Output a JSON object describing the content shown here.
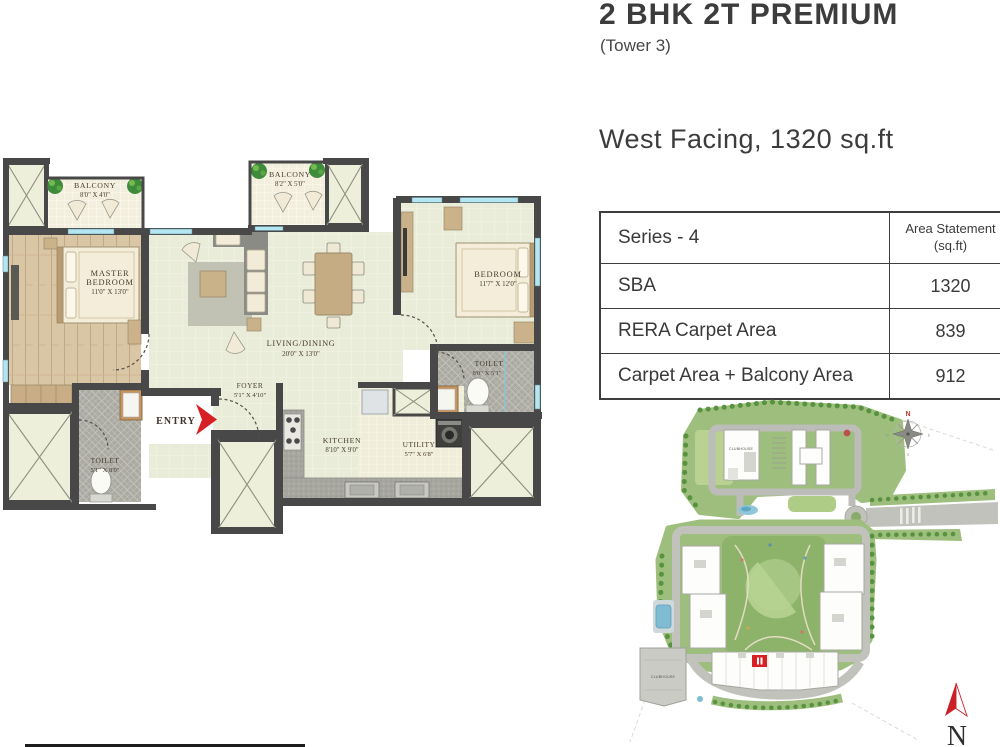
{
  "header": {
    "title": "2 BHK 2T PREMIUM",
    "tower": "(Tower 3)",
    "facing": "West Facing, 1320 sq.ft"
  },
  "area_table": {
    "series_label": "Series - 4",
    "area_header_line1": "Area Statement",
    "area_header_line2": "(sq.ft)",
    "rows": [
      {
        "label": "SBA",
        "value": "1320"
      },
      {
        "label": "RERA Carpet Area",
        "value": "839"
      },
      {
        "label": "Carpet Area + Balcony Area",
        "value": "912"
      }
    ]
  },
  "floorplan": {
    "entry_label": "ENTRY",
    "rooms": {
      "balcony1": {
        "name": "BALCONY",
        "dims": "8'0\" X 4'0\""
      },
      "balcony2": {
        "name": "BALCONY",
        "dims": "8'2\" X 5'0\""
      },
      "master_bedroom": {
        "line1": "MASTER",
        "line2": "BEDROOM",
        "dims": "11'0\" X 13'0\""
      },
      "living_dining": {
        "name": "LIVING/DINING",
        "dims": "20'0\" X 13'0\""
      },
      "bedroom": {
        "name": "BEDROOM",
        "dims": "11'7\" X 12'0\""
      },
      "toilet_right": {
        "name": "TOILET",
        "dims": "8'0\" X 5'1\""
      },
      "toilet_left": {
        "name": "TOILET",
        "dims": "5'1\" X 8'0\""
      },
      "foyer": {
        "name": "FOYER",
        "dims": "5'1\" X 4'10\""
      },
      "kitchen": {
        "name": "KITCHEN",
        "dims": "8'10\" X 9'0\""
      },
      "utility": {
        "name": "UTILITY",
        "dims": "5'7\" X 6'8\""
      }
    }
  },
  "sitemap": {
    "clubhouse_top": "CLUBHOUSE",
    "clubhouse_bottom": "CLUBHOUSE",
    "compass": {
      "n": "N",
      "e": "E",
      "s": "S",
      "w": "W"
    },
    "north_arrow_label": "N"
  },
  "colors": {
    "accent_red": "#d81f26",
    "wall": "#484848",
    "window_blue": "#b3e6f0"
  }
}
